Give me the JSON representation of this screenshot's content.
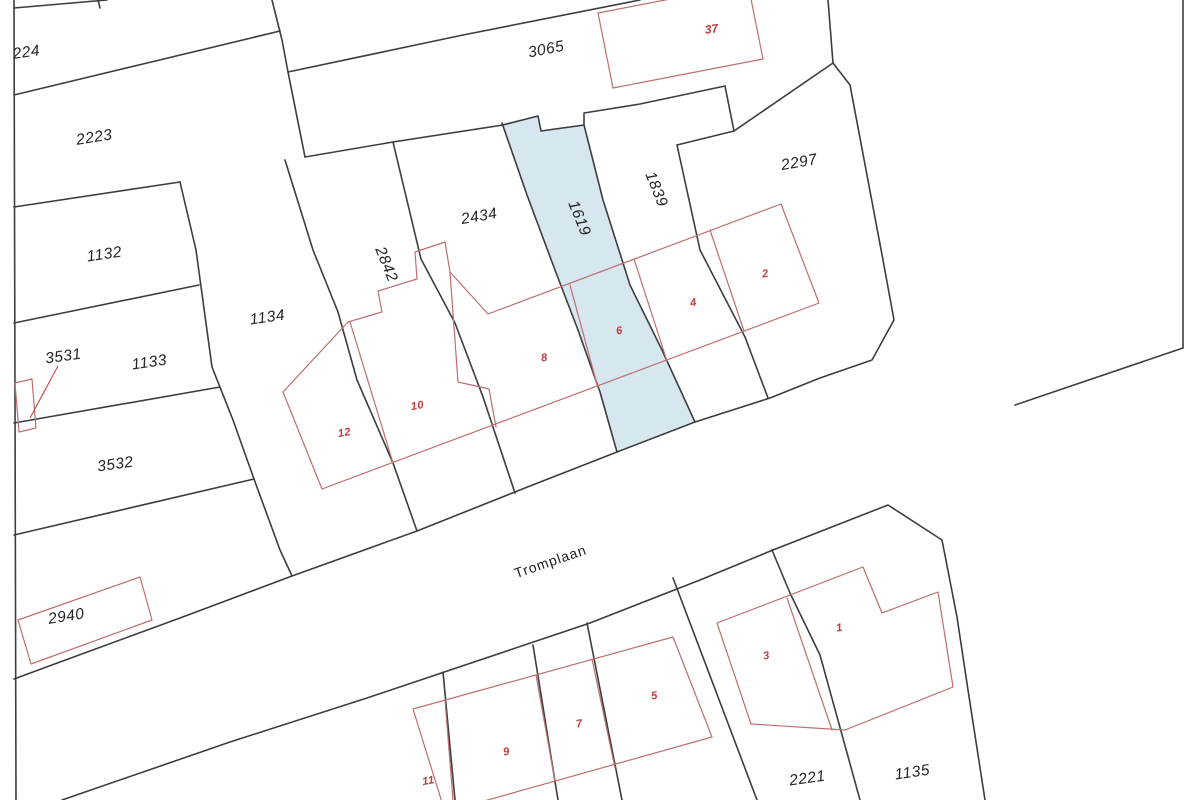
{
  "map": {
    "type": "cadastral-parcel-map",
    "street": {
      "name": "Tromplaan"
    },
    "highlighted_parcel": "1619",
    "colors": {
      "background": "#ffffff",
      "boundary_line": "#3d3d3d",
      "building_outline": "#bd6e6e",
      "building_number": "#c23c3c",
      "parcel_label": "#262626",
      "highlight_fill": "#d7e7ef"
    },
    "parcel_labels": [
      {
        "text": "224"
      },
      {
        "text": "2223"
      },
      {
        "text": "1132"
      },
      {
        "text": "1133"
      },
      {
        "text": "3531"
      },
      {
        "text": "3532"
      },
      {
        "text": "1134"
      },
      {
        "text": "2940"
      },
      {
        "text": "2842"
      },
      {
        "text": "2434"
      },
      {
        "text": "1619"
      },
      {
        "text": "1839"
      },
      {
        "text": "3065"
      },
      {
        "text": "2297"
      },
      {
        "text": "2221"
      },
      {
        "text": "1135"
      }
    ],
    "building_numbers": [
      {
        "text": "37"
      },
      {
        "text": "12"
      },
      {
        "text": "10"
      },
      {
        "text": "8"
      },
      {
        "text": "6"
      },
      {
        "text": "4"
      },
      {
        "text": "2"
      },
      {
        "text": "11"
      },
      {
        "text": "9"
      },
      {
        "text": "7"
      },
      {
        "text": "5"
      },
      {
        "text": "3"
      },
      {
        "text": "1"
      }
    ]
  }
}
